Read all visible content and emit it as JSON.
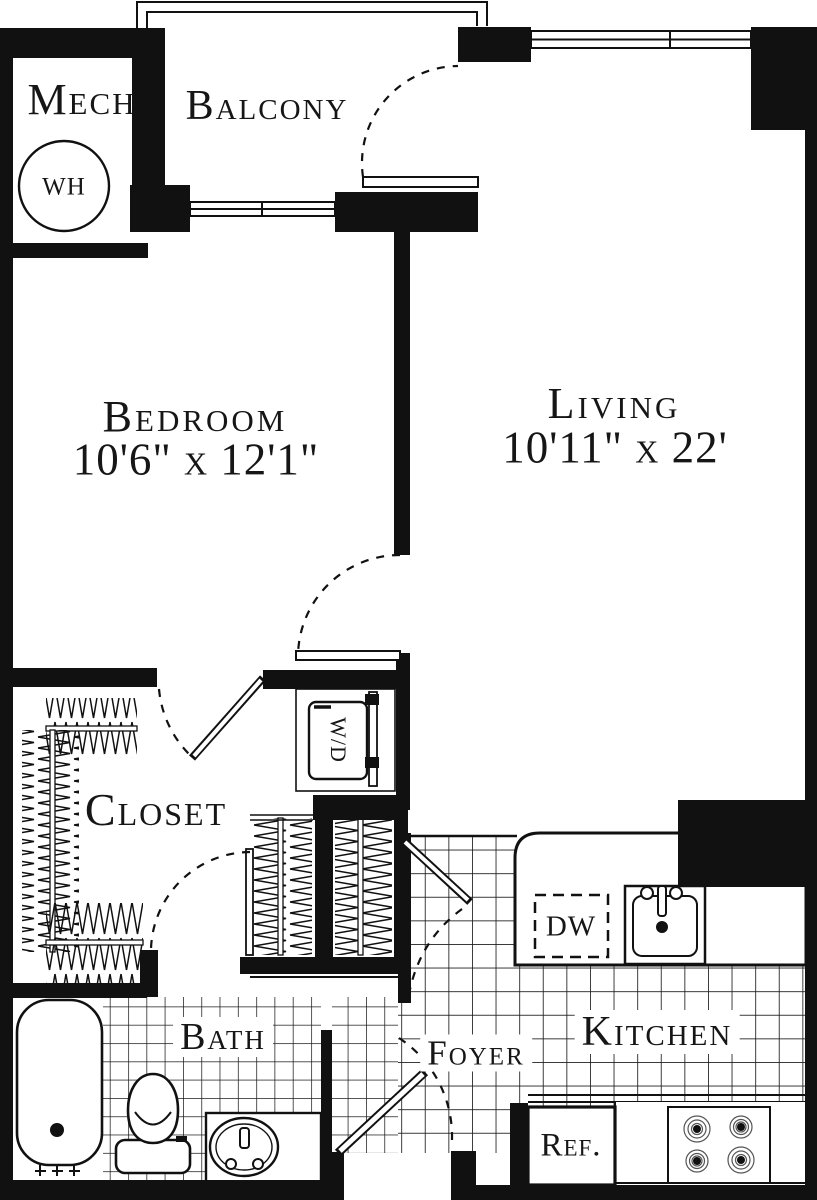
{
  "plan": {
    "title": "One-bedroom apartment floor plan",
    "rooms": {
      "mech": {
        "label": "Mech"
      },
      "balcony": {
        "label": "Balcony"
      },
      "bedroom": {
        "label": "Bedroom",
        "dimensions": "10'6\" x 12'1\""
      },
      "living": {
        "label": "Living",
        "dimensions": "10'11\" x 22'"
      },
      "closet": {
        "label": "Closet"
      },
      "bath": {
        "label": "Bath"
      },
      "foyer": {
        "label": "Foyer"
      },
      "kitchen": {
        "label": "Kitchen"
      }
    },
    "fixtures": {
      "water_heater": {
        "label": "WH"
      },
      "washer_dryer": {
        "label": "W/D"
      },
      "dishwasher": {
        "label": "DW"
      },
      "refrigerator": {
        "label": "Ref."
      }
    },
    "colors": {
      "line": "#111111",
      "floor": "#ffffff"
    }
  }
}
